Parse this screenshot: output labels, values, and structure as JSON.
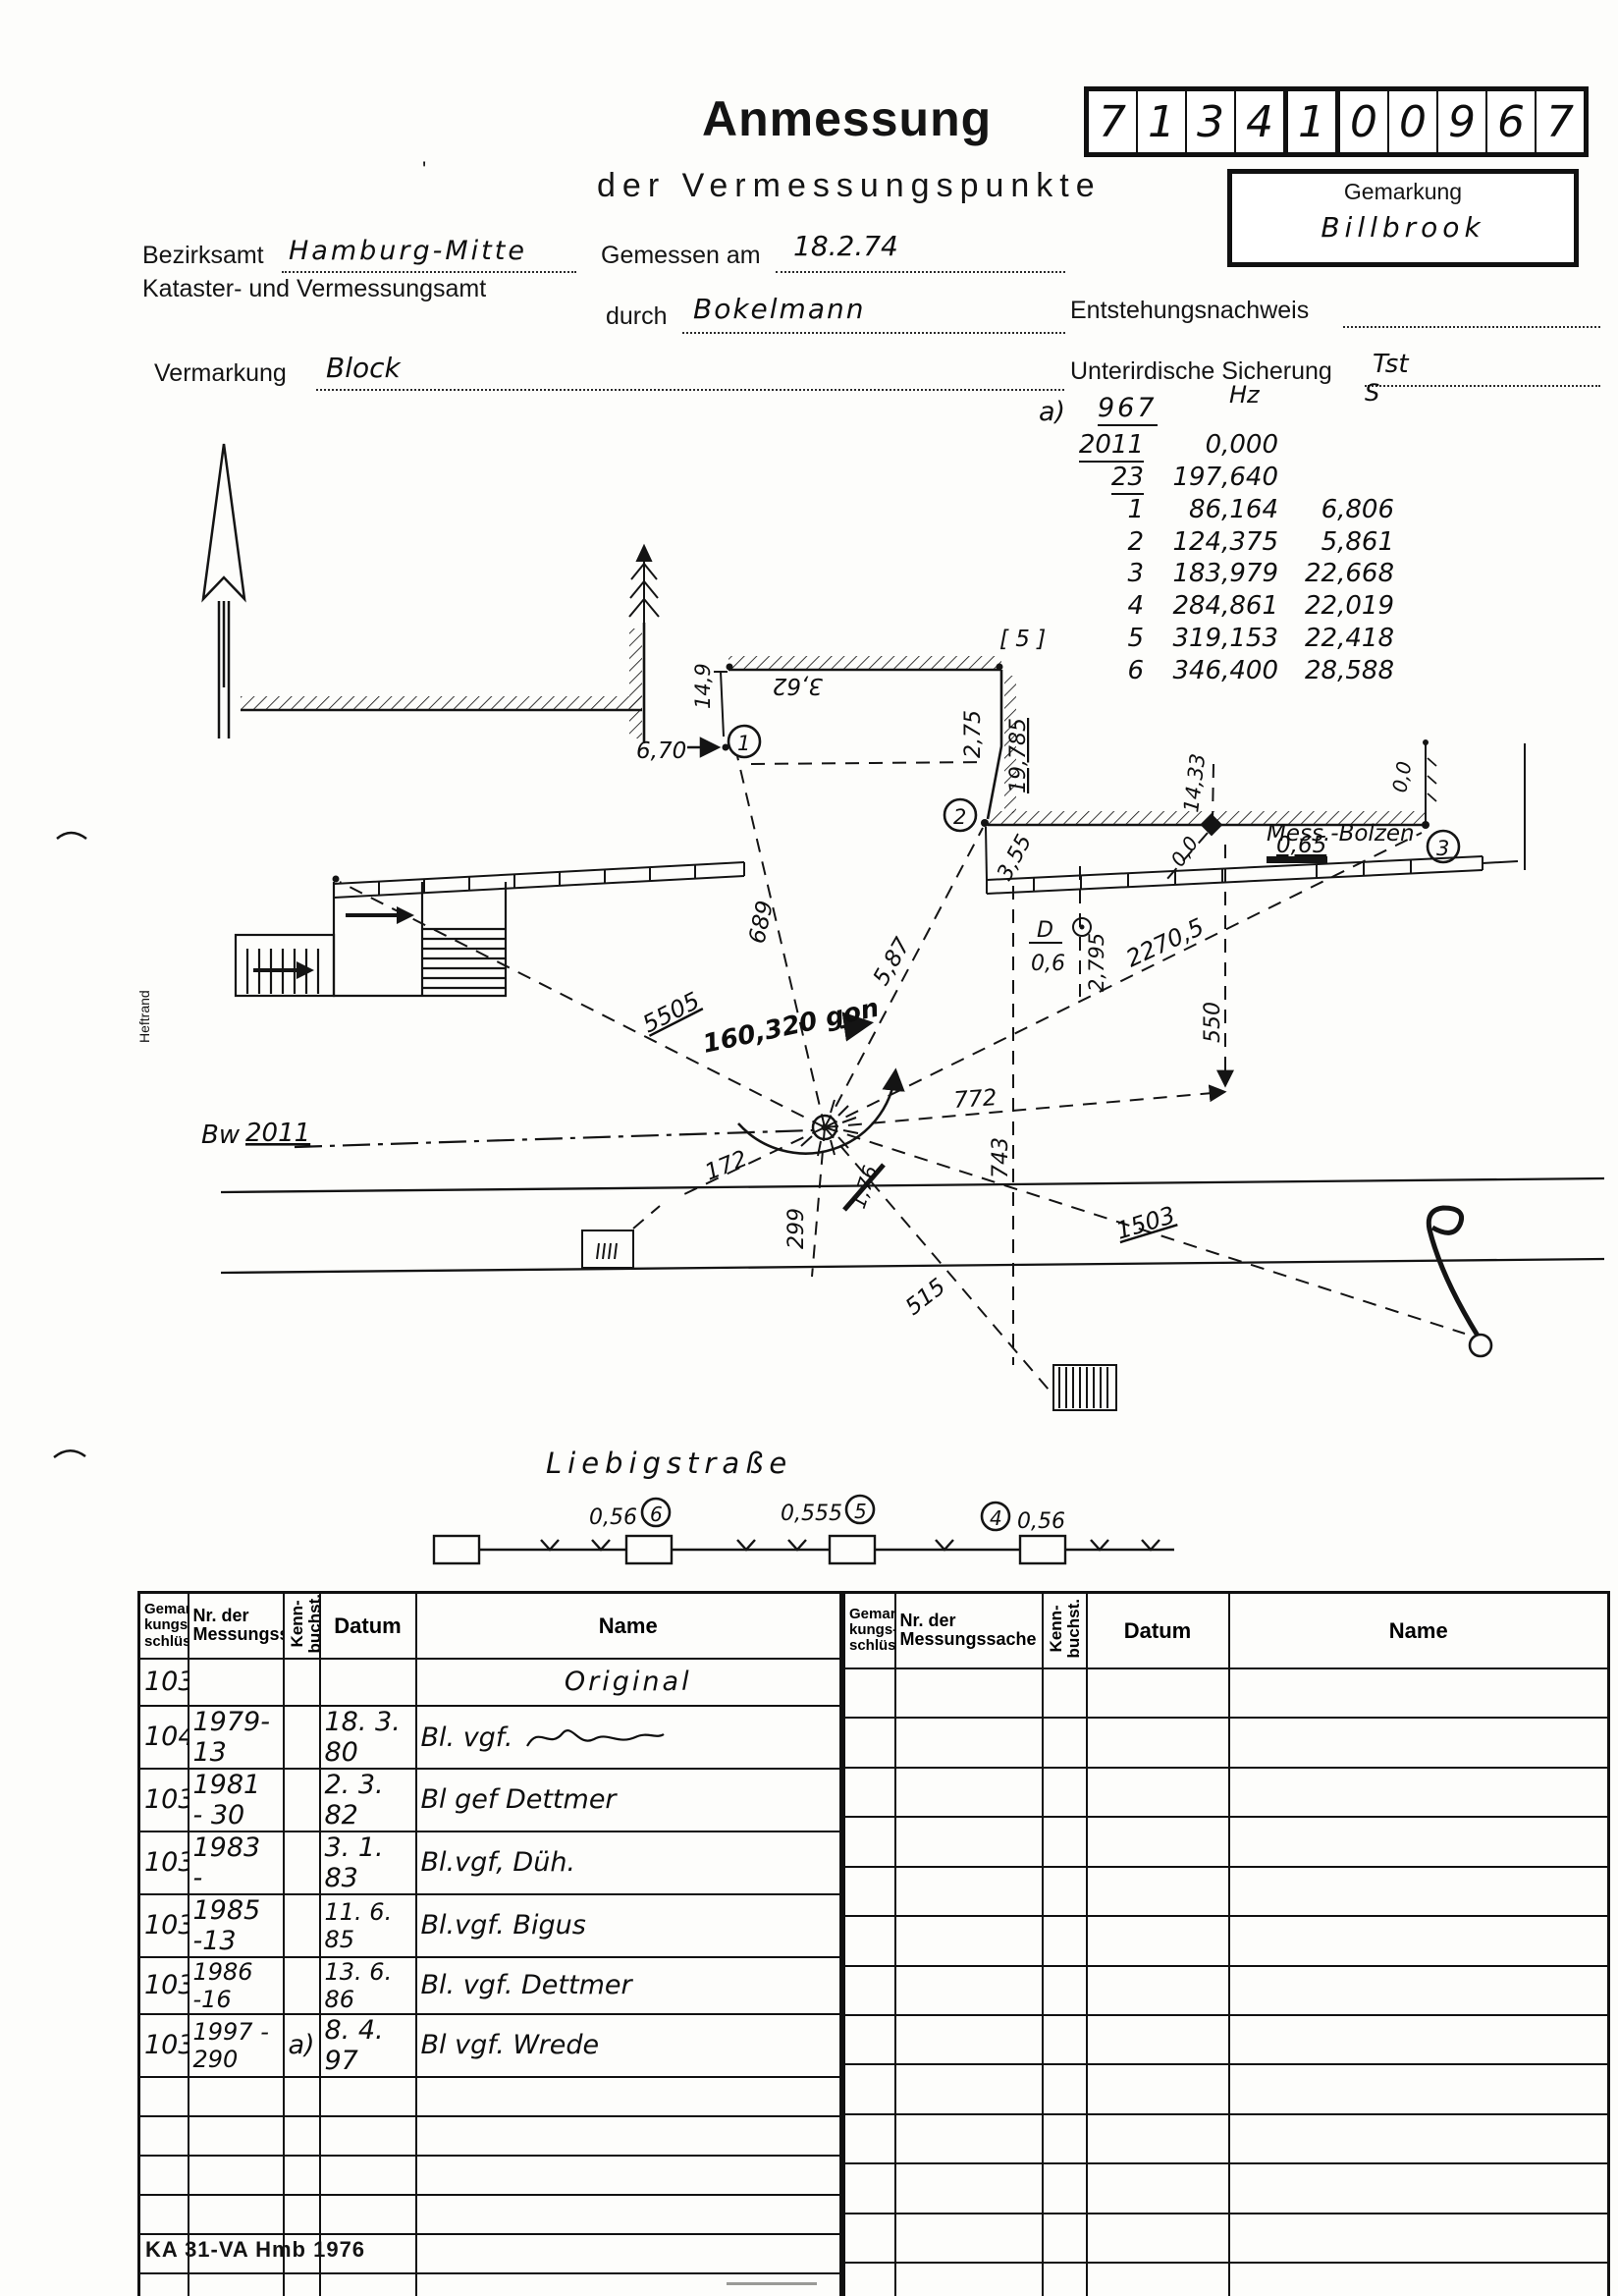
{
  "header": {
    "title": "Anmessung",
    "subtitle": "der Vermessungspunkte",
    "digits": [
      "7",
      "1",
      "3",
      "4",
      "1",
      "0",
      "0",
      "9",
      "6",
      "7"
    ],
    "gemarkung_label": "Gemarkung",
    "gemarkung_value": "Billbrook",
    "bezirksamt_label": "Bezirksamt",
    "bezirksamt_value": "Hamburg-Mitte",
    "amt_line": "Kataster- und Vermessungsamt",
    "gemessen_label": "Gemessen am",
    "gemessen_value": "18.2.74",
    "durch_label": "durch",
    "durch_value": "Bokelmann",
    "entstehung_label": "Entstehungsnachweis",
    "vermarkung_label": "Vermarkung",
    "vermarkung_value": "Block",
    "sicherung_label": "Unterirdische Sicherung",
    "sicherung_value": "Tst",
    "stray_mark": "'"
  },
  "observations": {
    "prefix": "a)",
    "station": "967",
    "col_hz": "Hz",
    "col_s": "S",
    "rows": [
      {
        "target": "2011",
        "hz": "0,000",
        "s": ""
      },
      {
        "target": "23",
        "hz": "197,640",
        "s": ""
      },
      {
        "target": "1",
        "hz": "86,164",
        "s": "6,806"
      },
      {
        "target": "2",
        "hz": "124,375",
        "s": "5,861"
      },
      {
        "target": "3",
        "hz": "183,979",
        "s": "22,668"
      },
      {
        "target": "4",
        "hz": "284,861",
        "s": "22,019"
      },
      {
        "target": "5",
        "hz": "319,153",
        "s": "22,418"
      },
      {
        "target": "6",
        "hz": "346,400",
        "s": "28,588"
      }
    ]
  },
  "sketch": {
    "labels": {
      "heftrand": "Heftrand",
      "bw": "Bw",
      "bw_num": "2011",
      "bracket5": "[ 5 ]",
      "wall_362": "3,62",
      "wall_149": "14,9",
      "p1_offset": "6,70",
      "d275": "2,75",
      "d19785": "19,785",
      "d355": "3,55",
      "d1433": "14,33",
      "zero_a": "0,0",
      "zero_b": "0,0",
      "bolzen": "Mess.-Bolzen",
      "bolzen_h": "0,65",
      "drain_d": "D",
      "drain_06": "0,6",
      "d2795": "2,795",
      "d22705": "2270,5",
      "d550": "550",
      "d689": "689",
      "d587": "5,87",
      "d5505": "5505",
      "angle": "160,320 gon",
      "d772": "772",
      "d743": "743",
      "d176": "1,76",
      "d299": "299",
      "d172": "172",
      "d1503": "1503",
      "d515": "515",
      "street": "Liebigstraße",
      "p1": "1",
      "p2": "2",
      "p3": "3",
      "p4": "4",
      "p5": "5",
      "p6": "6",
      "off6": "0,56",
      "off5": "0,555",
      "off4": "0,56"
    }
  },
  "table": {
    "headers": {
      "gem": "Gemar-\nkungs-\nschlüssel",
      "nr": "Nr. der\nMessungssache",
      "kenn": "Kenn-\nbuchst.",
      "datum": "Datum",
      "name": "Name"
    },
    "rows": [
      {
        "gem": "103",
        "nr": "",
        "kenn": "",
        "datum": "",
        "name": "Original"
      },
      {
        "gem": "104",
        "nr": "1979-13",
        "kenn": "",
        "datum": "18. 3. 80",
        "name": "Bl. vgf."
      },
      {
        "gem": "103",
        "nr": "1981 - 30",
        "kenn": "",
        "datum": "2. 3. 82",
        "name": "Bl gef Dettmer"
      },
      {
        "gem": "103",
        "nr": "1983 -",
        "kenn": "",
        "datum": "3. 1. 83",
        "name": "Bl.vgf,  Düh."
      },
      {
        "gem": "103",
        "nr": "1985 -13",
        "kenn": "",
        "datum": "11. 6. 85",
        "name": "Bl.vgf. Bigus"
      },
      {
        "gem": "103",
        "nr": "1986 -16",
        "kenn": "",
        "datum": "13. 6. 86",
        "name": "Bl. vgf. Dettmer"
      },
      {
        "gem": "103",
        "nr": "1997 - 290",
        "kenn": "a)",
        "datum": "8. 4. 97",
        "name": "Bl vgf. Wrede"
      }
    ]
  },
  "footer": {
    "form_id": "KA 31-VA Hmb 1976"
  }
}
